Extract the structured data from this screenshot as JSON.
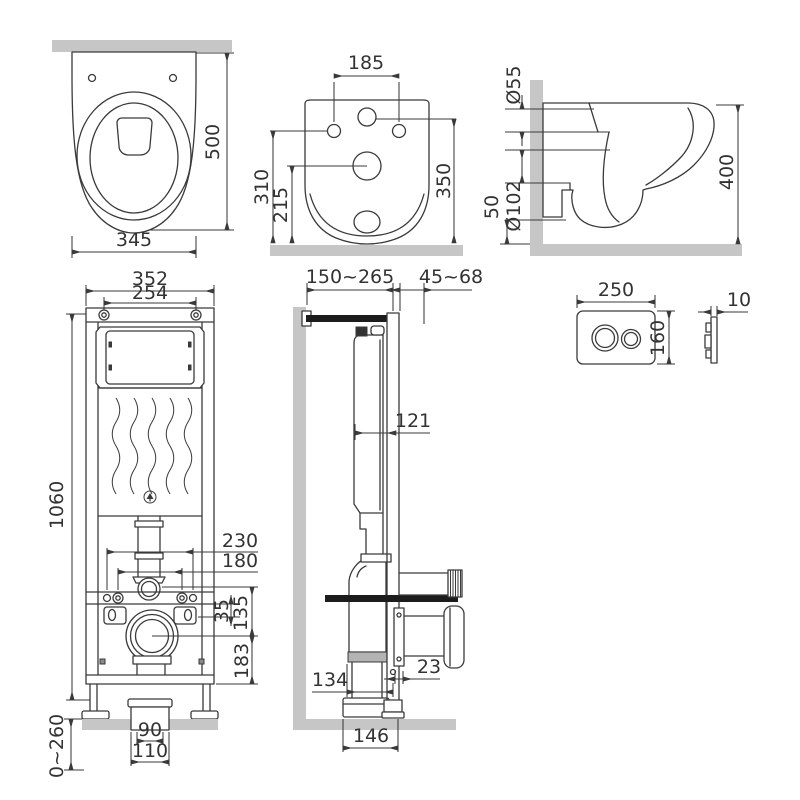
{
  "title": "Wall-hung toilet and concealed installation frame — dimensional drawing",
  "colors": {
    "line": "#3a3a3a",
    "surface": "#c6c6c6",
    "dark": "#1c1c1c",
    "seal": "#b3b3b3"
  },
  "views": {
    "bowl_top": {
      "name": "toilet bowl top view",
      "depth": "500",
      "width": "345"
    },
    "bowl_rear": {
      "name": "toilet bowl rear view",
      "hole_spacing": "185",
      "hole_height": "310",
      "drain_height": "215",
      "inlet_height": "350"
    },
    "bowl_side": {
      "name": "toilet bowl side view",
      "inlet_dia": "Ø55",
      "drain_dia": "Ø102",
      "drain_gap": "50",
      "height": "400"
    },
    "frame_front": {
      "name": "installation frame front view",
      "width": "352",
      "bolt_spacing": "254",
      "height": "1060",
      "stud_span": "230",
      "bolt_span": "180",
      "bar_offset": "35",
      "drain_offset": "135",
      "drain_to_base": "183",
      "outlet_inner": "90",
      "outlet_outer": "110",
      "floor_range": "0~260"
    },
    "frame_side": {
      "name": "installation frame side view",
      "depth_range": "150~265",
      "adapter_range": "45~68",
      "tank_depth": "121",
      "rail_gap": "23",
      "elbow_depth": "134",
      "base_depth": "146"
    },
    "flush_plate": {
      "name": "flush plate",
      "width": "250",
      "height": "160",
      "thickness": "10"
    }
  }
}
